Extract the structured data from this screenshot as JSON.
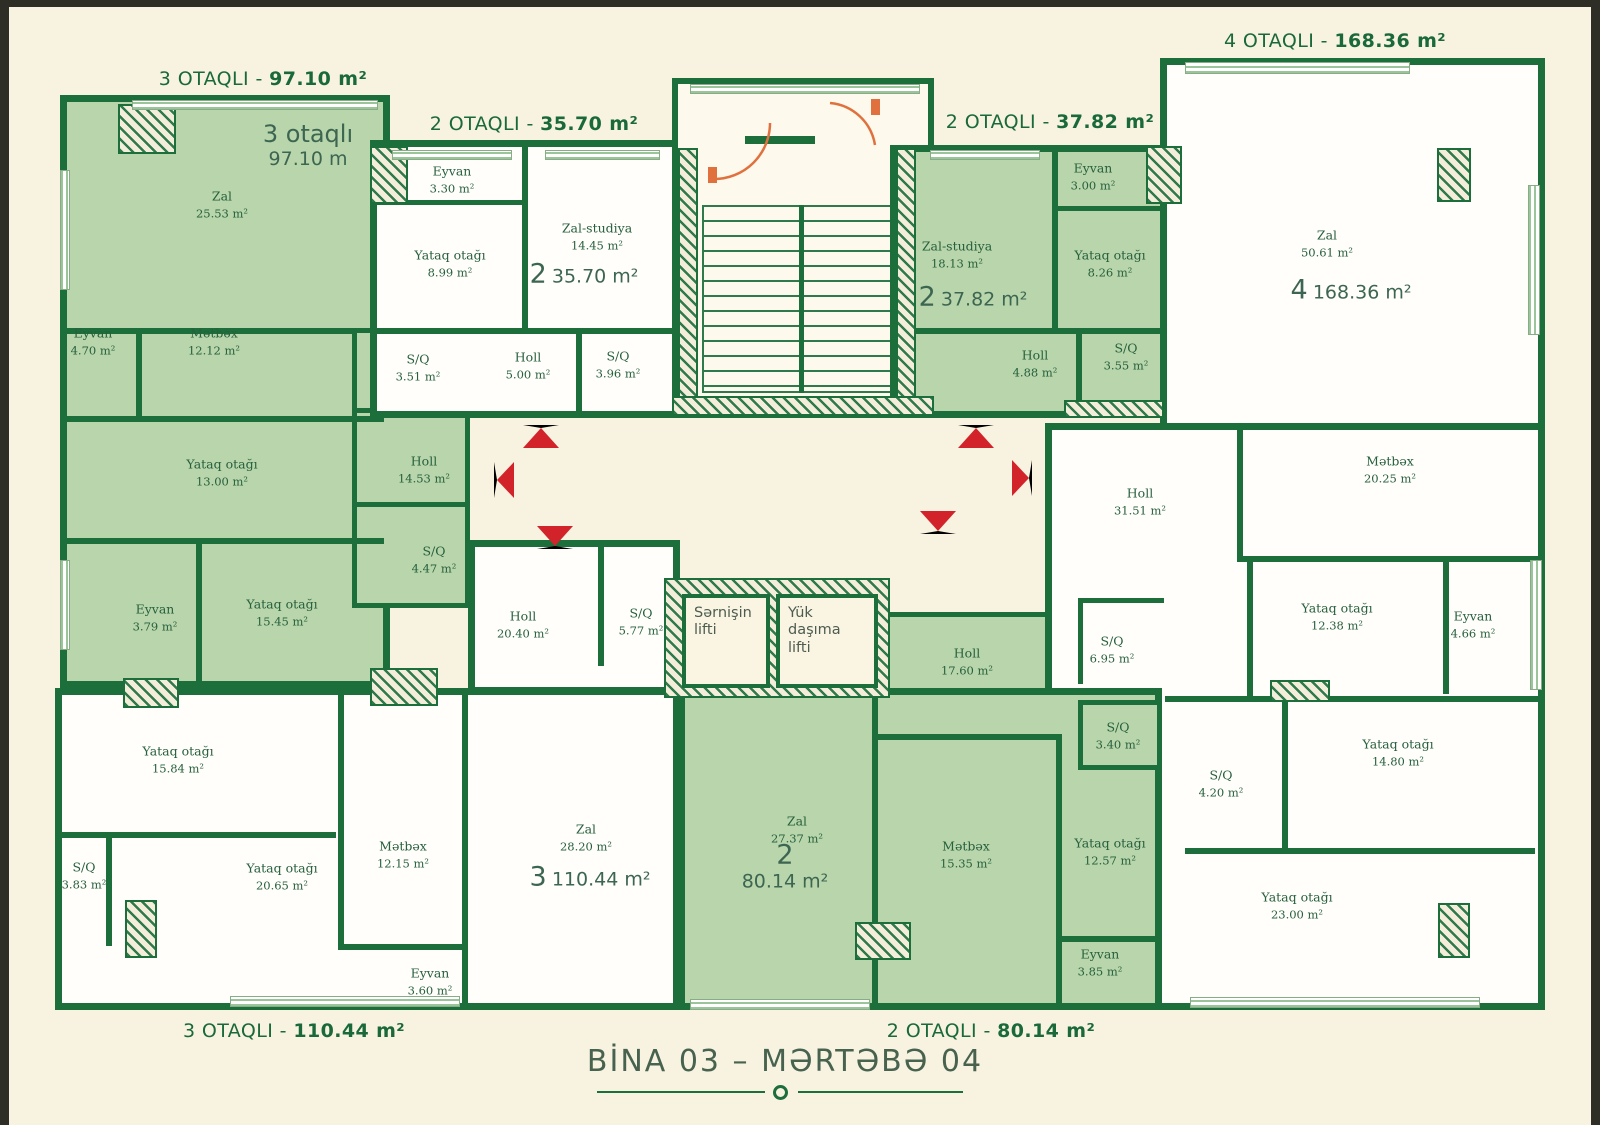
{
  "plan": {
    "title": "BİNA 03 – MƏRTƏBƏ 04",
    "colors": {
      "wall_green": "#1c6e3b",
      "room_fill_green": "#b8d5ab",
      "background_cream": "#f8f2e0",
      "arrow_red": "#d2232a",
      "door_arc_orange": "#e0713f",
      "header_green": "#19693a",
      "title_green": "#47624e"
    }
  },
  "elevators": {
    "passenger_label": "Sərnişin lifti",
    "freight_label": "Yük daşıma lifti"
  },
  "apartments": [
    {
      "header_label": "3 OTAQLI -",
      "header_area": "97.10 m²",
      "inner_line1": "3 otaqlı",
      "inner_line2": "97.10 m",
      "rooms": [
        {
          "name": "Zal",
          "area": "25.53 m²"
        },
        {
          "name": "Eyvan",
          "area": "4.70 m²"
        },
        {
          "name": "Mətbəx",
          "area": "12.12 m²"
        },
        {
          "name": "Yataq otağı",
          "area": "13.00 m²"
        },
        {
          "name": "Yataq otağı",
          "area": "15.45 m²"
        },
        {
          "name": "Eyvan",
          "area": "3.79 m²"
        },
        {
          "name": "Holl",
          "area": "14.53 m²"
        },
        {
          "name": "S/Q",
          "area": "4.47 m²"
        },
        {
          "name": "S/Q",
          "area": "3.51 m²"
        }
      ]
    },
    {
      "header_label": "2 OTAQLI -",
      "header_area": "35.70 m²",
      "unit_count": "2",
      "unit_area": "35.70 m²",
      "rooms": [
        {
          "name": "Eyvan",
          "area": "3.30 m²"
        },
        {
          "name": "Yataq otağı",
          "area": "8.99 m²"
        },
        {
          "name": "Zal-studiya",
          "area": "14.45 m²"
        },
        {
          "name": "Holl",
          "area": "5.00 m²"
        },
        {
          "name": "S/Q",
          "area": "3.96 m²"
        }
      ]
    },
    {
      "header_label": "2 OTAQLI -",
      "header_area": "37.82 m²",
      "unit_count": "2",
      "unit_area": "37.82 m²",
      "rooms": [
        {
          "name": "Eyvan",
          "area": "3.00 m²"
        },
        {
          "name": "Zal-studiya",
          "area": "18.13 m²"
        },
        {
          "name": "Yataq otağı",
          "area": "8.26 m²"
        },
        {
          "name": "Holl",
          "area": "4.88 m²"
        },
        {
          "name": "S/Q",
          "area": "3.55 m²"
        }
      ]
    },
    {
      "header_label": "4 OTAQLI -",
      "header_area": "168.36 m²",
      "unit_count": "4",
      "unit_area": "168.36 m²",
      "rooms": [
        {
          "name": "Zal",
          "area": "50.61 m²"
        },
        {
          "name": "Mətbəx",
          "area": "20.25 m²"
        },
        {
          "name": "Holl",
          "area": "31.51 m²"
        },
        {
          "name": "S/Q",
          "area": "6.95 m²"
        },
        {
          "name": "Yataq otağı",
          "area": "12.38 m²"
        },
        {
          "name": "Eyvan",
          "area": "4.66 m²"
        },
        {
          "name": "Yataq otağı",
          "area": "14.80 m²"
        },
        {
          "name": "S/Q",
          "area": "4.20 m²"
        },
        {
          "name": "Yataq otağı",
          "area": "23.00 m²"
        }
      ]
    },
    {
      "header_label": "3 OTAQLI -",
      "header_area": "110.44 m²",
      "unit_count": "3",
      "unit_area": "110.44 m²",
      "rooms": [
        {
          "name": "Yataq otağı",
          "area": "15.84 m²"
        },
        {
          "name": "Yataq otağı",
          "area": "20.65 m²"
        },
        {
          "name": "S/Q",
          "area": "3.83 m²"
        },
        {
          "name": "Mətbəx",
          "area": "12.15 m²"
        },
        {
          "name": "Holl",
          "area": "20.40 m²"
        },
        {
          "name": "S/Q",
          "area": "5.77 m²"
        },
        {
          "name": "Zal",
          "area": "28.20 m²"
        },
        {
          "name": "Eyvan",
          "area": "3.60 m²"
        }
      ]
    },
    {
      "header_label": "2 OTAQLI -",
      "header_area": "80.14 m²",
      "unit_count": "2",
      "unit_area": "80.14 m²",
      "rooms": [
        {
          "name": "Zal",
          "area": "27.37 m²"
        },
        {
          "name": "Mətbəx",
          "area": "15.35 m²"
        },
        {
          "name": "Yataq otağı",
          "area": "12.57 m²"
        },
        {
          "name": "Holl",
          "area": "17.60 m²"
        },
        {
          "name": "S/Q",
          "area": "3.40 m²"
        },
        {
          "name": "Eyvan",
          "area": "3.85 m²"
        }
      ]
    }
  ]
}
